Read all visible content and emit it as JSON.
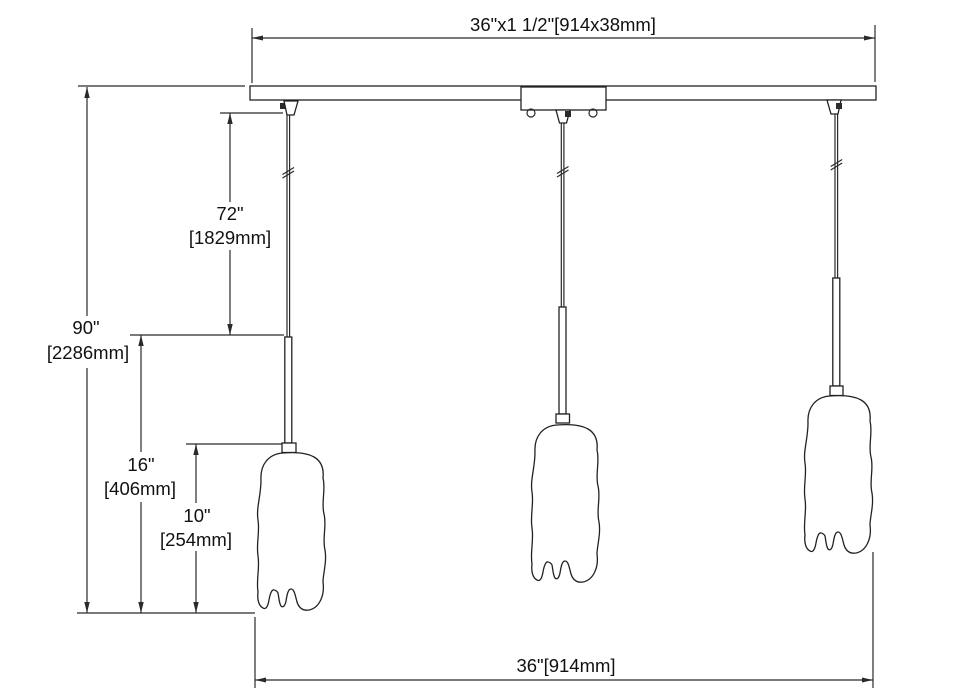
{
  "page": {
    "background": "#ffffff",
    "line_color": "#2a2a2a"
  },
  "drawing": {
    "type": "dimension-diagram",
    "subject": "3-light linear pendant fixture line drawing",
    "labels": {
      "canopy_size": "36\"x1 1/2\"[914x38mm]",
      "overall_height_in": "90\"",
      "overall_height_mm": "[2286mm]",
      "cord_length_in": "72\"",
      "cord_length_mm": "[1829mm]",
      "stem_shade_in": "16\"",
      "stem_shade_mm": "[406mm]",
      "shade_height_in": "10\"",
      "shade_height_mm": "[254mm]",
      "overall_width": "36\"[914mm]"
    },
    "dimensions_data": [
      {
        "name": "canopy-bar",
        "inches": "36 x 1 1/2",
        "mm": "914 x 38"
      },
      {
        "name": "overall-height",
        "inches": "90",
        "mm": "2286"
      },
      {
        "name": "cord-length",
        "inches": "72",
        "mm": "1829"
      },
      {
        "name": "stem-plus-shade",
        "inches": "16",
        "mm": "406"
      },
      {
        "name": "shade-height",
        "inches": "10",
        "mm": "254"
      },
      {
        "name": "overall-width",
        "inches": "36",
        "mm": "914"
      }
    ]
  }
}
